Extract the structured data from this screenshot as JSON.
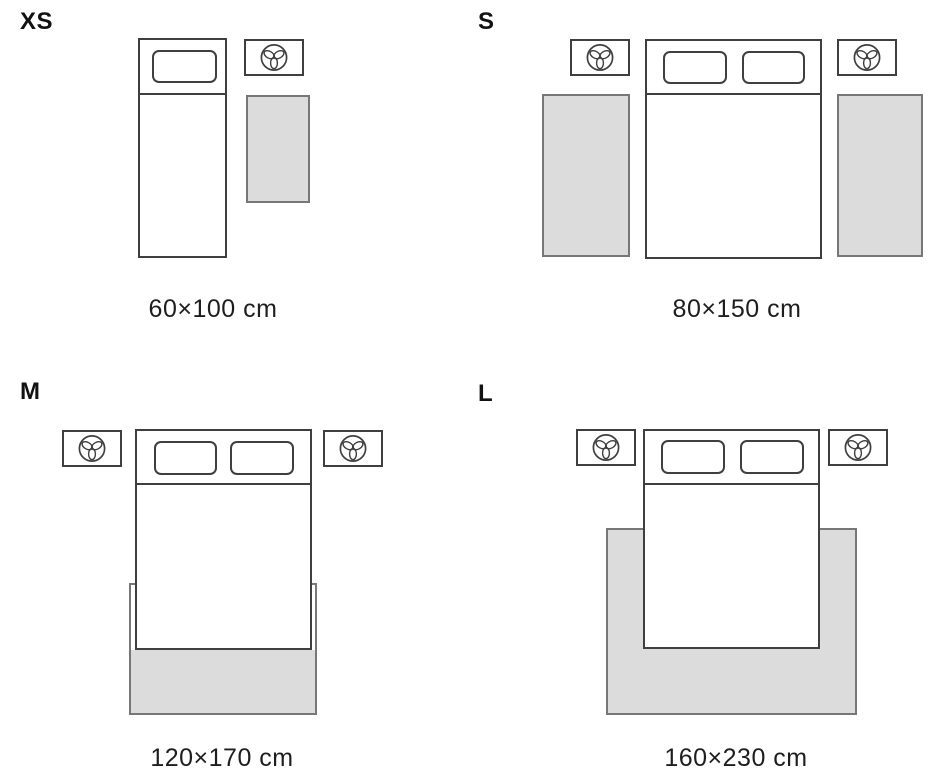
{
  "page": {
    "background": "#ffffff",
    "description": "Rug size guide diagram with four bedroom top-view scenes"
  },
  "colors": {
    "outline": "#3f3f3f",
    "rug_fill": "#dcdcdc",
    "rug_border": "#777777",
    "text": "#1e1e1e"
  },
  "icons": {
    "lamp": "trefoil-lamp-icon"
  },
  "sizes": [
    {
      "label": "XS",
      "dimensions": "60×100 cm",
      "scene": "single bed with one pillow, nightstand with lamp, rug beside bed"
    },
    {
      "label": "S",
      "dimensions": "80×150 cm",
      "scene": "double bed with two pillows, two nightstands, one rug on each side of bed"
    },
    {
      "label": "M",
      "dimensions": "120×170 cm",
      "scene": "double bed with two pillows, two nightstands, rug under foot of bed extending below"
    },
    {
      "label": "L",
      "dimensions": "160×230 cm",
      "scene": "double bed with two pillows, two nightstands, large rug under most of bed"
    }
  ]
}
